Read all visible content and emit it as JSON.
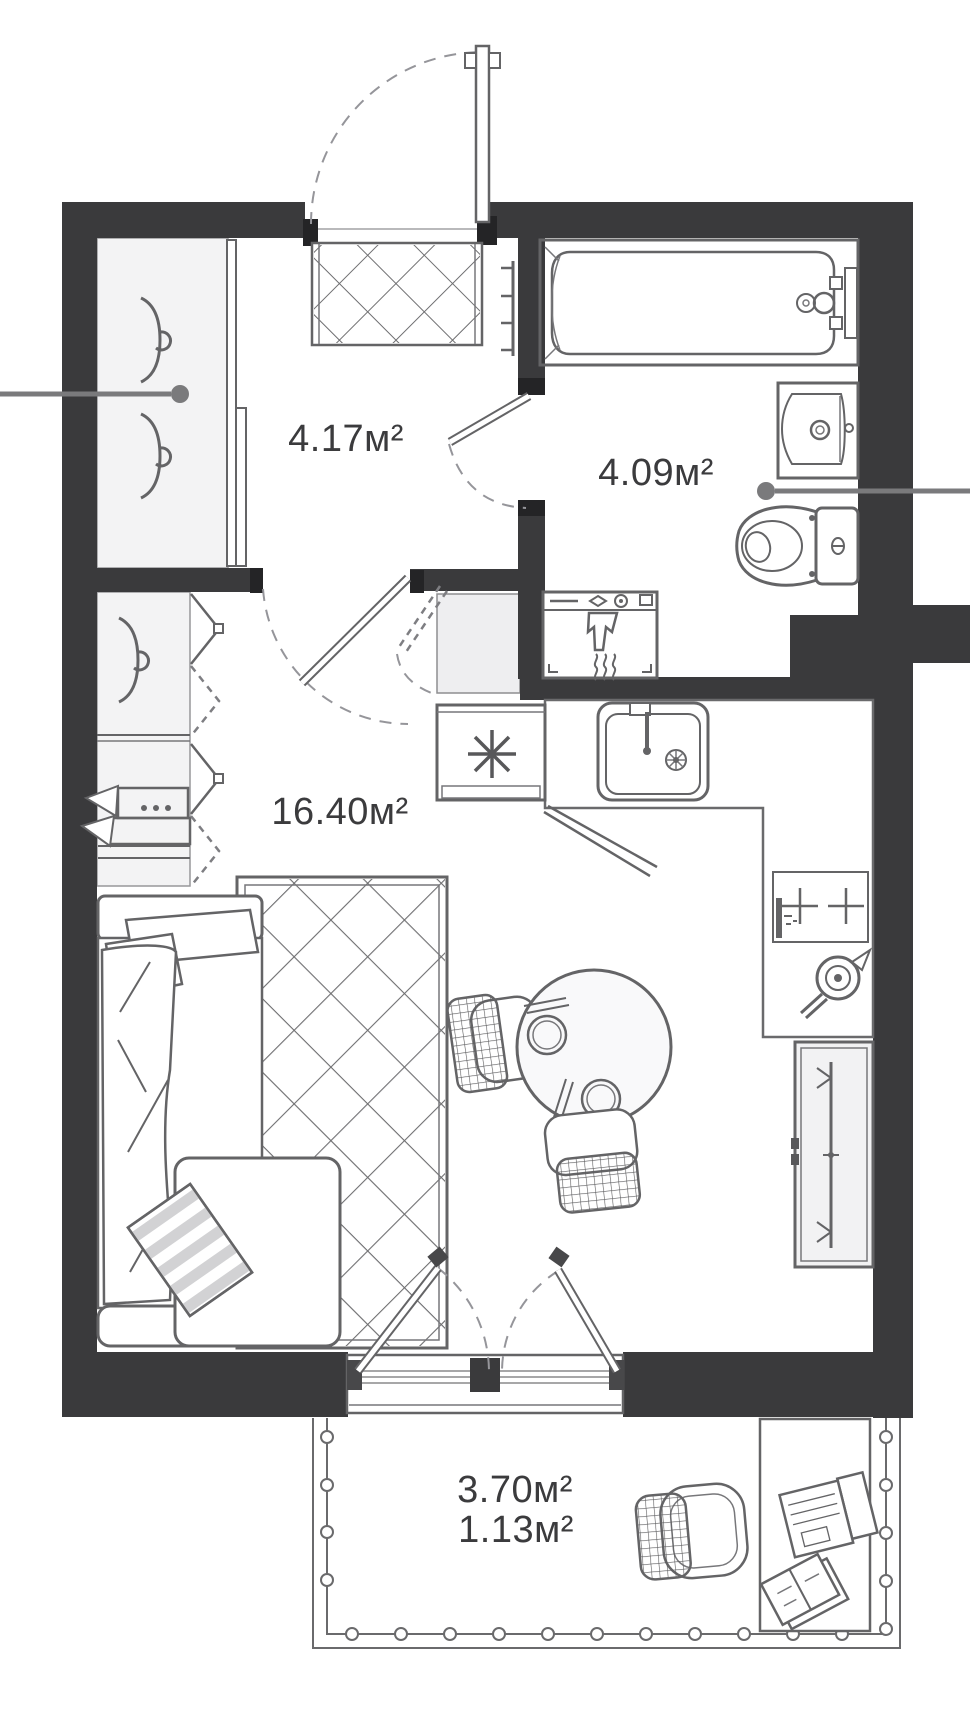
{
  "labels": {
    "hallway": "4.17м²",
    "bathroom": "4.09м²",
    "living_room": "16.40м²",
    "balcony_full": "3.70м²",
    "balcony_coefficient": "1.13м²"
  },
  "icons": {
    "refrigerator-icon": "8-spoke asterisk",
    "cooktop-icon": "two plus burners",
    "coat-hook-icon": "profile hook with curl",
    "door-swing-icon": "dashed quarter arc",
    "balcony-railing-icon": "double line with round balusters"
  },
  "fixtures": [
    "bathtub",
    "washbasin",
    "toilet",
    "washing-machine",
    "towel-rail",
    "kitchen-sink",
    "cooktop",
    "kettle",
    "refrigerator",
    "dining-table",
    "chairs",
    "bed-sofa",
    "rug",
    "wardrobe",
    "sliding-closet",
    "doormat",
    "balcony-desk",
    "laptop",
    "notebook",
    "balcony-chair"
  ],
  "colors": {
    "wall": "#3a3a3c",
    "fixture_line": "#646466",
    "floor_light": "#f3f3f4",
    "label_text": "#3b3b3d",
    "axis_marker": "#7a7a7c"
  }
}
